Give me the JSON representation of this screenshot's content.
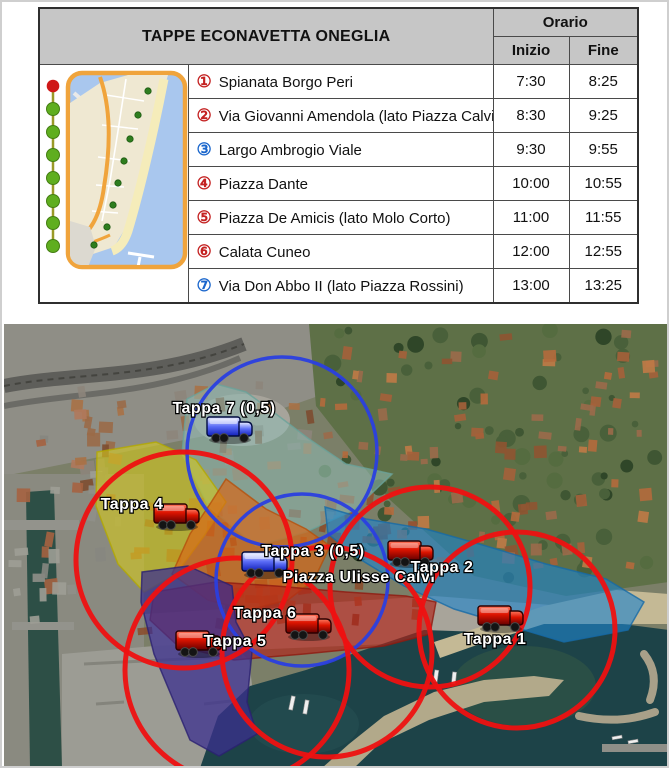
{
  "table": {
    "title": "TAPPE ECONAVETTA ONEGLIA",
    "orario": "Orario",
    "inizio": "Inizio",
    "fine": "Fine",
    "rows": [
      {
        "num": "①",
        "num_color": "#c42222",
        "stop": "Spianata Borgo Peri",
        "inizio": "7:30",
        "fine": "8:25"
      },
      {
        "num": "②",
        "num_color": "#c42222",
        "stop": "Via Giovanni Amendola (lato Piazza Calvi)",
        "inizio": "8:30",
        "fine": "9:25"
      },
      {
        "num": "③",
        "num_color": "#1a66cc",
        "stop": "Largo Ambrogio Viale",
        "inizio": "9:30",
        "fine": "9:55"
      },
      {
        "num": "④",
        "num_color": "#c42222",
        "stop": "Piazza Dante",
        "inizio": "10:00",
        "fine": "10:55"
      },
      {
        "num": "⑤",
        "num_color": "#c42222",
        "stop": "Piazza De Amicis (lato Molo Corto)",
        "inizio": "11:00",
        "fine": "11:55"
      },
      {
        "num": "⑥",
        "num_color": "#c42222",
        "stop": "Calata Cuneo",
        "inizio": "12:00",
        "fine": "12:55"
      },
      {
        "num": "⑦",
        "num_color": "#1a66cc",
        "stop": "Via Don Abbo II (lato Piazza Rossini)",
        "inizio": "13:00",
        "fine": "13:25"
      }
    ]
  },
  "map": {
    "zones": [
      {
        "name": "tappa-7-zone",
        "color": "#8fbcb4",
        "opacity": 0.55,
        "stroke": "#6aa39a",
        "points": "183,75 212,60 242,68 272,90 305,115 342,140 388,150 350,186 302,208 252,222 205,183 178,130"
      },
      {
        "name": "tappa-4-zone",
        "color": "#d6ca1c",
        "opacity": 0.6,
        "stroke": "#b3a900",
        "points": "93,128 152,118 192,136 222,178 200,212 172,250 140,268 114,240 92,182"
      },
      {
        "name": "tappa-3-zone",
        "color": "#d96515",
        "opacity": 0.68,
        "stroke": "#b5500d",
        "points": "222,155 262,185 302,205 326,222 310,256 284,276 244,286 204,276 168,250 186,210 206,180"
      },
      {
        "name": "tappa-6-zone",
        "color": "#b02318",
        "opacity": 0.66,
        "stroke": "#8f1a10",
        "points": "150,268 212,258 272,262 342,268 402,272 432,278 426,310 380,322 300,330 230,336 174,322 146,296"
      },
      {
        "name": "tappa-5-zone",
        "color": "#3b2f8f",
        "opacity": 0.74,
        "stroke": "#2a2070",
        "points": "138,248 184,242 228,262 232,298 248,328 243,378 253,410 215,432 186,416 150,330 137,278"
      },
      {
        "name": "tappa-2-zone",
        "color": "#1f85cc",
        "opacity": 0.62,
        "stroke": "#176aa6",
        "points": "321,183 362,195 422,205 482,222 542,240 602,255 640,278 624,306 560,318 500,300 450,285 400,262 354,234 324,210"
      }
    ],
    "circles": [
      {
        "name": "tappa-7-radius",
        "cx": 278,
        "cy": 128,
        "r": 95,
        "color": "#2a3fe0",
        "width": 3.5
      },
      {
        "name": "tappa-3-radius",
        "cx": 298,
        "cy": 256,
        "r": 86,
        "color": "#2a3fe0",
        "width": 3.5
      },
      {
        "name": "tappa-4-radius",
        "cx": 180,
        "cy": 236,
        "r": 108,
        "color": "#ee1111",
        "width": 5
      },
      {
        "name": "tappa-2-radius",
        "cx": 426,
        "cy": 263,
        "r": 100,
        "color": "#ee1111",
        "width": 5
      },
      {
        "name": "tappa-6-radius",
        "cx": 323,
        "cy": 328,
        "r": 105,
        "color": "#ee1111",
        "width": 5
      },
      {
        "name": "tappa-5-radius",
        "cx": 233,
        "cy": 346,
        "r": 112,
        "color": "#ee1111",
        "width": 5
      },
      {
        "name": "tappa-1-radius",
        "cx": 513,
        "cy": 306,
        "r": 98,
        "color": "#ee1111",
        "width": 5
      }
    ],
    "trucks": [
      {
        "name": "tappa-7-bus",
        "x": 226,
        "y": 105,
        "color": "blue"
      },
      {
        "name": "tappa-4-bus",
        "x": 173,
        "y": 192,
        "color": "red"
      },
      {
        "name": "tappa-3-bus",
        "x": 261,
        "y": 240,
        "color": "blue"
      },
      {
        "name": "tappa-2-bus",
        "x": 407,
        "y": 229,
        "color": "red"
      },
      {
        "name": "tappa-6-bus",
        "x": 305,
        "y": 302,
        "color": "red"
      },
      {
        "name": "tappa-5-bus",
        "x": 195,
        "y": 319,
        "color": "red"
      },
      {
        "name": "tappa-1-bus",
        "x": 497,
        "y": 294,
        "color": "red"
      }
    ],
    "labels": [
      {
        "name": "tappa-7-label",
        "text": "Tappa 7 (0,5)",
        "x": 220,
        "y": 89
      },
      {
        "name": "tappa-4-label",
        "text": "Tappa 4",
        "x": 128,
        "y": 185
      },
      {
        "name": "tappa-3-label",
        "text": "Tappa 3 (0,5)",
        "x": 309,
        "y": 232
      },
      {
        "name": "piazza-label",
        "text": "Piazza Ulisse Calvi",
        "x": 355,
        "y": 258
      },
      {
        "name": "tappa-6-label",
        "text": "Tappa 6",
        "x": 261,
        "y": 294
      },
      {
        "name": "tappa-5-label",
        "text": "Tappa 5",
        "x": 231,
        "y": 322
      },
      {
        "name": "tappa-2-label",
        "text": "Tappa 2",
        "x": 438,
        "y": 248
      },
      {
        "name": "tappa-1-label",
        "text": "Tappa 1",
        "x": 491,
        "y": 320
      }
    ]
  }
}
